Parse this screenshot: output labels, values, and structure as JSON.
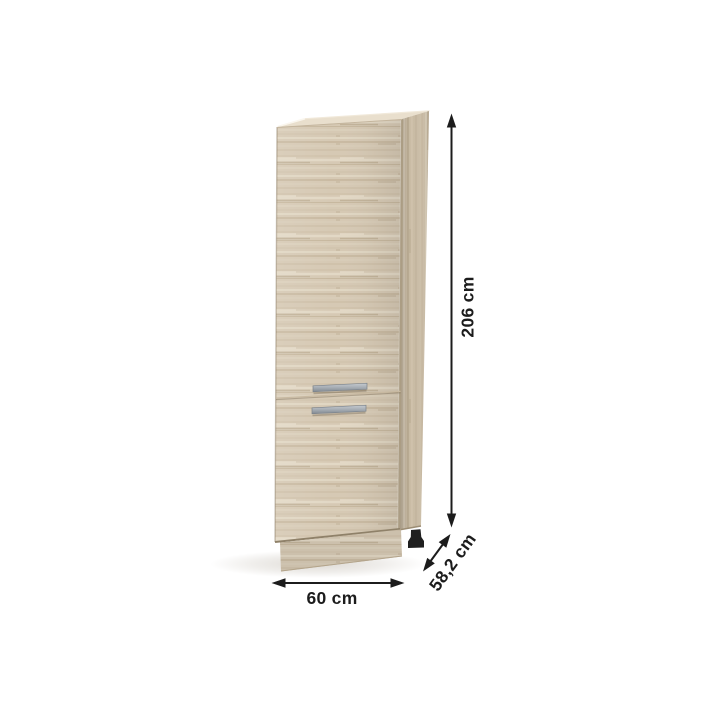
{
  "page": {
    "background": "#ffffff"
  },
  "cabinet": {
    "type": "two-door tall pantry cabinet",
    "finish": "sonoma oak",
    "colors": {
      "front_wood": "#d6c9b4",
      "side_wood": "#cbbda6",
      "top_wood": "#e9dfcd",
      "handle_light": "#c6cbd0",
      "handle_dark": "#828a92",
      "foot": "#1f1f1f"
    }
  },
  "dimensions": {
    "line_color": "#1c1c1c",
    "text_color": "#1c1c1c",
    "height": {
      "label": "206 cm"
    },
    "width": {
      "label": "60 cm"
    },
    "depth": {
      "label": "58,2 cm"
    }
  }
}
